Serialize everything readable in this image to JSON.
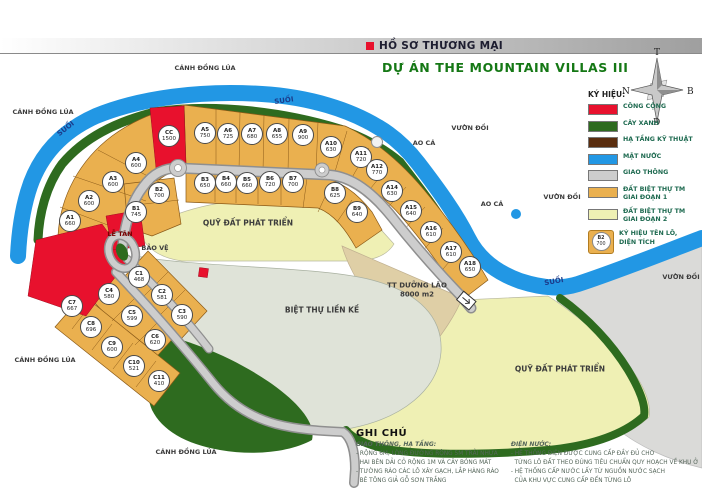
{
  "header": {
    "doc_label": "HỒ SƠ THƯƠNG MẠI",
    "title": "DỰ ÁN THE MOUNTAIN VILLAS III"
  },
  "compass": {
    "top": "T",
    "left": "N",
    "right": "B",
    "bottom": "Đ"
  },
  "colors": {
    "public_red": "#e8112d",
    "tree_green": "#2e6b1f",
    "infra_brown": "#5a2d0e",
    "water_blue": "#2297e4",
    "road_gray": "#cdcdcd",
    "phase1_orange": "#eab04f",
    "phase2_yellow": "#eff0b4",
    "title_green": "#157815"
  },
  "legend": {
    "title": "KÝ HIỆU:",
    "items": [
      {
        "kind": "swatch",
        "color": "#e8112d",
        "label": "CÔNG CỘNG"
      },
      {
        "kind": "swatch",
        "color": "#2e6b1f",
        "label": "CÂY XANH"
      },
      {
        "kind": "swatch",
        "color": "#5a2d0e",
        "label": "HẠ TẦNG KỸ THUẬT"
      },
      {
        "kind": "swatch",
        "color": "#2297e4",
        "label": "MẶT NƯỚC"
      },
      {
        "kind": "swatch",
        "color": "#cdcdcd",
        "label": "GIAO THÔNG"
      },
      {
        "kind": "swatch",
        "color": "#eab04f",
        "label": "ĐẤT BIỆT THỰ TM",
        "label2": "GIAI ĐOẠN 1"
      },
      {
        "kind": "swatch",
        "color": "#eff0b4",
        "label": "ĐẤT BIỆT THỰ TM",
        "label2": "GIAI ĐOẠN 2"
      },
      {
        "kind": "plot-symbol",
        "symbol_id": "B2",
        "symbol_area": "700",
        "label": "KÝ HIỆU TÊN LÔ,",
        "label2": "DIỆN TÍCH"
      }
    ]
  },
  "plots": [
    {
      "id": "CC",
      "area": "1500",
      "x": 169,
      "y": 136
    },
    {
      "id": "A1",
      "area": "660",
      "x": 70,
      "y": 221
    },
    {
      "id": "A2",
      "area": "600",
      "x": 89,
      "y": 201
    },
    {
      "id": "A3",
      "area": "600",
      "x": 113,
      "y": 182
    },
    {
      "id": "A4",
      "area": "600",
      "x": 136,
      "y": 163
    },
    {
      "id": "A5",
      "area": "750",
      "x": 205,
      "y": 133
    },
    {
      "id": "A6",
      "area": "725",
      "x": 228,
      "y": 134
    },
    {
      "id": "A7",
      "area": "680",
      "x": 252,
      "y": 134
    },
    {
      "id": "A8",
      "area": "655",
      "x": 277,
      "y": 134
    },
    {
      "id": "A9",
      "area": "900",
      "x": 303,
      "y": 135
    },
    {
      "id": "A10",
      "area": "630",
      "x": 331,
      "y": 147
    },
    {
      "id": "A11",
      "area": "720",
      "x": 361,
      "y": 157
    },
    {
      "id": "A12",
      "area": "770",
      "x": 377,
      "y": 170
    },
    {
      "id": "A14",
      "area": "630",
      "x": 392,
      "y": 191
    },
    {
      "id": "A15",
      "area": "640",
      "x": 411,
      "y": 211
    },
    {
      "id": "A16",
      "area": "610",
      "x": 431,
      "y": 232
    },
    {
      "id": "A17",
      "area": "610",
      "x": 451,
      "y": 252
    },
    {
      "id": "A18",
      "area": "650",
      "x": 470,
      "y": 267
    },
    {
      "id": "B1",
      "area": "745",
      "x": 136,
      "y": 212
    },
    {
      "id": "B2",
      "area": "700",
      "x": 159,
      "y": 193
    },
    {
      "id": "B3",
      "area": "650",
      "x": 205,
      "y": 183
    },
    {
      "id": "B4",
      "area": "660",
      "x": 226,
      "y": 182
    },
    {
      "id": "B5",
      "area": "660",
      "x": 247,
      "y": 183
    },
    {
      "id": "B6",
      "area": "720",
      "x": 270,
      "y": 182
    },
    {
      "id": "B7",
      "area": "700",
      "x": 293,
      "y": 182
    },
    {
      "id": "B8",
      "area": "625",
      "x": 335,
      "y": 193
    },
    {
      "id": "B9",
      "area": "640",
      "x": 357,
      "y": 212
    },
    {
      "id": "C1",
      "area": "468",
      "x": 139,
      "y": 277
    },
    {
      "id": "C2",
      "area": "581",
      "x": 162,
      "y": 295
    },
    {
      "id": "C3",
      "area": "590",
      "x": 182,
      "y": 315
    },
    {
      "id": "C4",
      "area": "580",
      "x": 109,
      "y": 294
    },
    {
      "id": "C5",
      "area": "599",
      "x": 132,
      "y": 316
    },
    {
      "id": "C6",
      "area": "620",
      "x": 155,
      "y": 340
    },
    {
      "id": "C7",
      "area": "667",
      "x": 72,
      "y": 306
    },
    {
      "id": "C8",
      "area": "696",
      "x": 91,
      "y": 327
    },
    {
      "id": "C9",
      "area": "600",
      "x": 112,
      "y": 347
    },
    {
      "id": "C10",
      "area": "521",
      "x": 134,
      "y": 366
    },
    {
      "id": "C11",
      "area": "410",
      "x": 159,
      "y": 381
    }
  ],
  "map_labels": [
    {
      "text": "CÁNH ĐỒNG LÚA",
      "x": 205,
      "y": 68,
      "size": 6.5
    },
    {
      "text": "CÁNH ĐỒNG LÚA",
      "x": 43,
      "y": 112,
      "size": 6.5
    },
    {
      "text": "SUỐI",
      "x": 284,
      "y": 101,
      "rot": -8,
      "size": 7,
      "color": "#1b3c8c"
    },
    {
      "text": "SUỐI",
      "x": 66,
      "y": 129,
      "rot": -38,
      "size": 7,
      "color": "#1b3c8c"
    },
    {
      "text": "VƯỜN ĐỒI",
      "x": 470,
      "y": 128,
      "size": 6.5
    },
    {
      "text": "AO CÁ",
      "x": 424,
      "y": 143,
      "size": 6.5
    },
    {
      "text": "AO CÁ",
      "x": 492,
      "y": 204,
      "size": 6.5
    },
    {
      "text": "VƯỜN ĐỒI",
      "x": 562,
      "y": 197,
      "size": 6.5
    },
    {
      "text": "SUỐI",
      "x": 554,
      "y": 282,
      "rot": -10,
      "size": 7,
      "color": "#1b3c8c"
    },
    {
      "text": "VƯỜN ĐỒI",
      "x": 681,
      "y": 277,
      "size": 6.5
    },
    {
      "text": "CÁNH ĐỒNG LÚA",
      "x": 45,
      "y": 360,
      "size": 6.5
    },
    {
      "text": "CÁNH ĐỒNG LÚA",
      "x": 186,
      "y": 452,
      "size": 6.5
    },
    {
      "text": "QUỸ ĐẤT PHÁT TRIỂN",
      "x": 248,
      "y": 223,
      "size": 7.5
    },
    {
      "text": "QUỸ ĐẤT PHÁT TRIỂN",
      "x": 560,
      "y": 369,
      "size": 7.5
    },
    {
      "text": "BIỆT THỰ LIỀN KỀ",
      "x": 322,
      "y": 310,
      "size": 7.5
    },
    {
      "text": "TT DƯỠNG LÃO",
      "text2": "8000 m2",
      "x": 417,
      "y": 290,
      "size": 7
    },
    {
      "text": "LỄ TÂN",
      "x": 120,
      "y": 234,
      "size": 6.5,
      "color": "#7a0000"
    },
    {
      "text": "BẢO VỆ",
      "x": 155,
      "y": 248,
      "size": 6.5
    }
  ],
  "notes": {
    "title": "GHI CHÚ",
    "sections": [
      {
        "heading": "GIAO THÔNG, HẠ TẦNG:",
        "lines": [
          "- RỘNG 6M, LÒNG ĐƯỜNG RỘNG 5M TRẢI NHỰA",
          "  HAI BÊN DẢI CỎ RỘNG 1M VÀ CÂY BÓNG MÁT",
          "- TƯỜNG RÀO CÁC LÔ XÂY GẠCH, LẮP HÀNG RÀO",
          "  BÊ TÔNG GIẢ GỖ SƠN TRẮNG"
        ]
      },
      {
        "heading": "ĐIỆN NƯỚC:",
        "lines": [
          "- HỆ THỐNG ĐIỆN ĐƯỢC CUNG CẤP ĐẦY ĐỦ CHO",
          "  TỪNG LÔ ĐẤT THEO ĐÚNG TIÊU CHUẨN QUY HOẠCH VỀ KHU Ở",
          "- HỆ THỐNG CẤP NƯỚC LẤY TỪ NGUỒN NƯỚC SẠCH",
          "  CỦA KHU VỰC CUNG CẤP ĐẾN TỪNG LÔ"
        ]
      }
    ]
  }
}
